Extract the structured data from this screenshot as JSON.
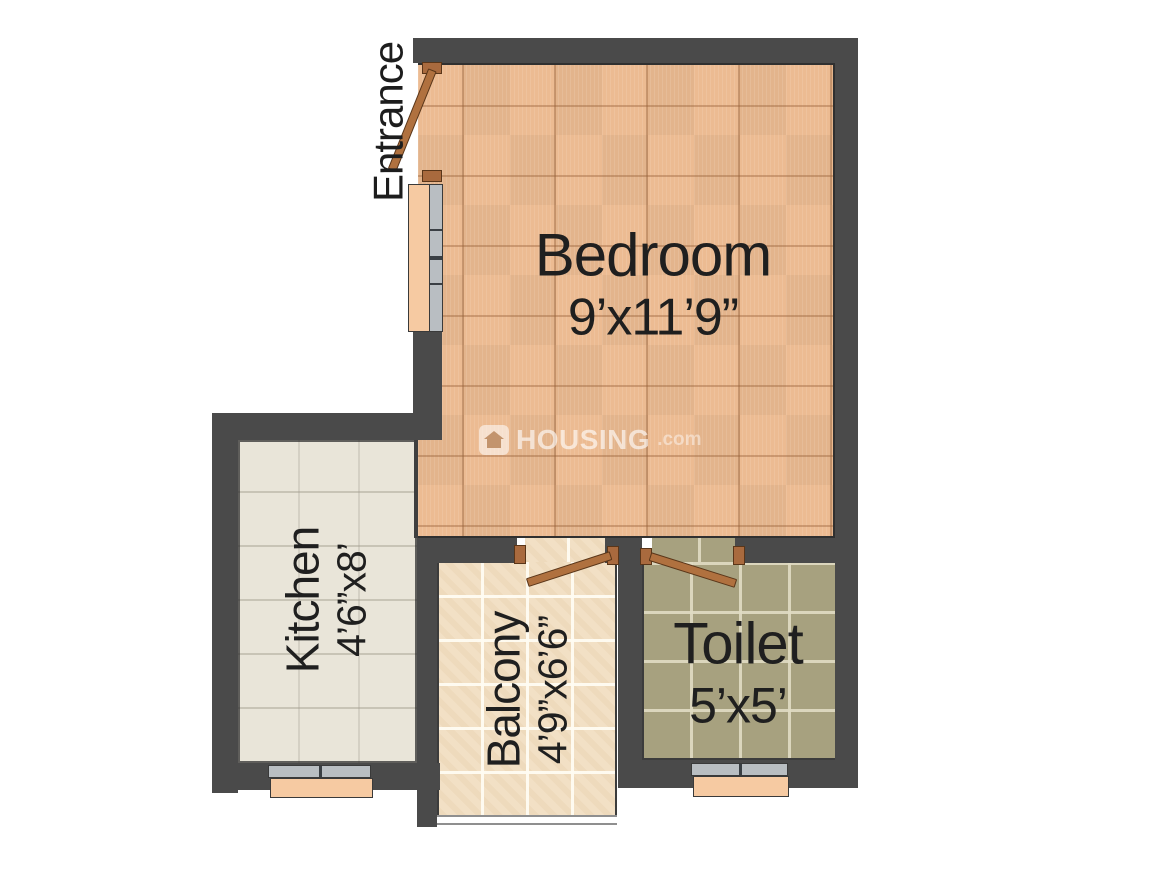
{
  "plan": {
    "entrance_label": "Entrance",
    "rooms": {
      "bedroom": {
        "name": "Bedroom",
        "dims": "9’x11’9”"
      },
      "kitchen": {
        "name": "Kitchen",
        "dims": "4’6”x8’"
      },
      "balcony": {
        "name": "Balcony",
        "dims": "4’9”x6’6”"
      },
      "toilet": {
        "name": "Toilet",
        "dims": "5’x5’"
      }
    }
  },
  "watermark": {
    "brand": "HOUSING",
    "tld": ".com"
  },
  "colors": {
    "wall": "#4a4a4a",
    "bedroom_floor": "#ecbb92",
    "kitchen_floor": "#e9e5d9",
    "balcony_floor": "#f2e0c5",
    "toilet_floor": "#a7a17f",
    "door": "#b0713f",
    "window_sill": "#f6caa2",
    "window_glass": "#b9bec2",
    "label_text": "#1f1f1f"
  }
}
